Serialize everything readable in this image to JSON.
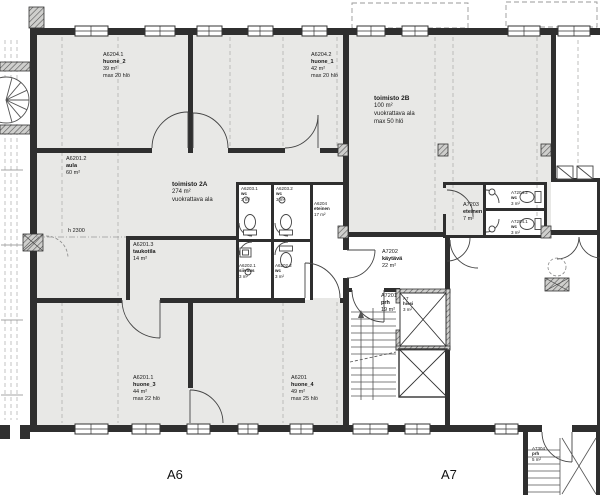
{
  "drawing": {
    "type": "architectural floor plan",
    "height_note": "h 2300",
    "wings": {
      "a6": "A6",
      "a7": "A7"
    }
  },
  "colors": {
    "room_fill": "#e8e8e6",
    "wall": "#2f2f2f",
    "dashed_line": "#b5b5b5"
  },
  "rooms": [
    {
      "id": "A6204.1",
      "name": "huone_2",
      "area": "39 m²",
      "cap": "max 20 hlö"
    },
    {
      "id": "A6204.2",
      "name": "huone_1",
      "area": "42 m²",
      "cap": "max 20 hlö"
    },
    {
      "id": "",
      "name": "toimisto 2B",
      "area": "100 m²",
      "note": "vuokrattava ala",
      "cap": "max 50 hlö"
    },
    {
      "id": "A6201.2",
      "name": "aula",
      "area": "60 m²"
    },
    {
      "id": "",
      "name": "toimisto 2A",
      "area": "274 m²",
      "note": "vuokrattava ala"
    },
    {
      "id": "A6203.1",
      "name": "wc",
      "area": "3 m²"
    },
    {
      "id": "A6203.2",
      "name": "wc",
      "area": "3 m²"
    },
    {
      "id": "A6204",
      "name": "eteinen",
      "area": "17 m²"
    },
    {
      "id": "A7203",
      "name": "eteinen",
      "area": "7 m²"
    },
    {
      "id": "A7204.2",
      "name": "wc",
      "area": "3 m²"
    },
    {
      "id": "A7204.1",
      "name": "wc",
      "area": "3 m²"
    },
    {
      "id": "A6201.3",
      "name": "taukotila",
      "area": "14 m²"
    },
    {
      "id": "A6202.1",
      "name": "siivous",
      "area": "3 m²"
    },
    {
      "id": "A6202.2",
      "name": "wc",
      "area": "3 m²"
    },
    {
      "id": "A7202",
      "name": "käytävä",
      "area": "22 m²"
    },
    {
      "id": "A7201",
      "name": "prh",
      "area": "19 m²"
    },
    {
      "id": "A7",
      "name": "hissi",
      "area": "3 m²"
    },
    {
      "id": "A6201.1",
      "name": "huone_3",
      "area": "44 m²",
      "cap": "max 22 hlö"
    },
    {
      "id": "A6201",
      "name": "huone_4",
      "area": "49 m²",
      "cap": "max 25 hlö"
    },
    {
      "id": "A7304",
      "name": "prh",
      "area": "5 m²"
    }
  ]
}
